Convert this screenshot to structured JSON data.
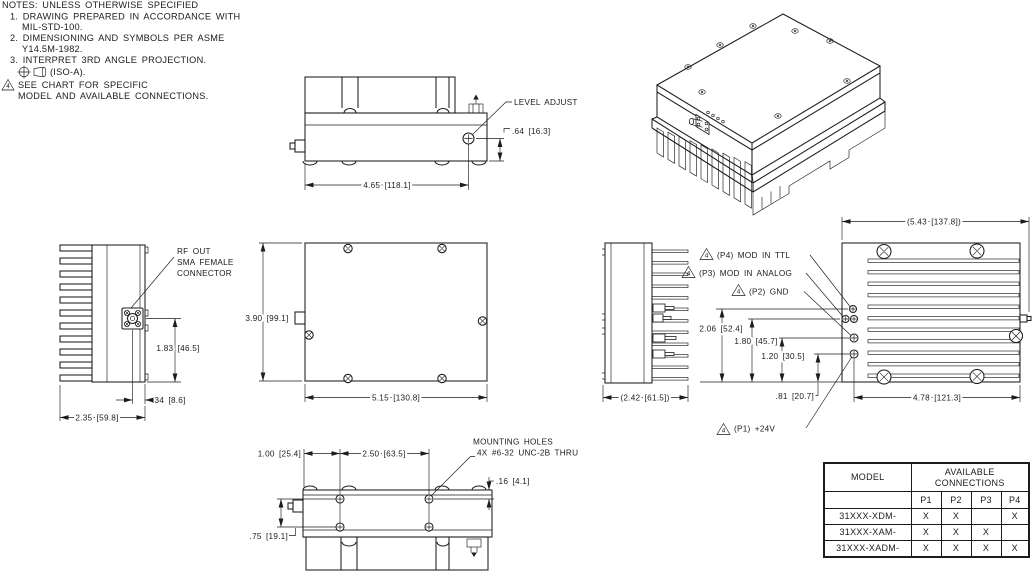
{
  "notes": {
    "header": "NOTES: UNLESS OTHERWISE SPECIFIED",
    "note1_line1": "1. DRAWING PREPARED IN ACCORDANCE WITH",
    "note1_line2": "MIL-STD-100.",
    "note2_line1": "2. DIMENSIONING AND SYMBOLS PER ASME",
    "note2_line2": "Y14.5M-1982.",
    "note3_line1": "3. INTERPRET 3RD ANGLE PROJECTION.",
    "note3_line2": "(ISO-A).",
    "note4_flag": "4",
    "note4_line1": "SEE CHART FOR SPECIFIC",
    "note4_line2": "MODEL AND AVAILABLE CONNECTIONS."
  },
  "front_view": {
    "level_adjust_label": "LEVEL ADJUST",
    "dim_level_adjust_height": ".64 [16.3]",
    "dim_width": "4.65 [118.1]"
  },
  "left_side_view": {
    "rf_out_line1": "RF OUT",
    "rf_out_line2": "SMA FEMALE",
    "rf_out_line3": "CONNECTOR",
    "dim_connector_height": "1.83 [46.5]",
    "dim_connector_offset": ".34 [8.6]",
    "dim_depth": "2.35 [59.8]"
  },
  "top_view": {
    "dim_height": "3.90 [99.1]",
    "dim_width": "5.15 [130.8]"
  },
  "right_side_view": {
    "dim_depth": "(2.42 [61.5])"
  },
  "back_view": {
    "dim_overall_width": "(5.43 [137.8])",
    "dim_mounting_width": "4.78 [121.3]",
    "ports": [
      {
        "flag": "4",
        "label": "(P4) MOD IN TTL",
        "dim": "2.06 [52.4]"
      },
      {
        "flag": "4",
        "label": "(P3) MOD IN ANALOG",
        "dim": "1.80 [45.7]"
      },
      {
        "flag": "4",
        "label": "(P2) GND",
        "dim": "1.20 [30.5]"
      },
      {
        "flag": "4",
        "label": "(P1) +24V",
        "dim": ".81 [20.7]"
      }
    ]
  },
  "mounting_view": {
    "dim_edge_to_hole": "1.00 [25.4]",
    "dim_hole_spacing": "2.50 [63.5]",
    "dim_hole_to_edge": ".16 [4.1]",
    "dim_hole_rows": ".75 [19.1]",
    "holes_label_line1": "MOUNTING HOLES",
    "holes_label_line2": "4X #6-32 UNC-2B THRU"
  },
  "connections_table": {
    "model_header": "MODEL",
    "avail_header_line1": "AVAILABLE",
    "avail_header_line2": "CONNECTIONS",
    "port_headers": [
      "P1",
      "P2",
      "P3",
      "P4"
    ],
    "rows": [
      {
        "model": "31XXX-XDM-",
        "p1": "X",
        "p2": "X",
        "p3": "",
        "p4": "X"
      },
      {
        "model": "31XXX-XAM-",
        "p1": "X",
        "p2": "X",
        "p3": "X",
        "p4": ""
      },
      {
        "model": "31XXX-XADM-",
        "p1": "X",
        "p2": "X",
        "p3": "X",
        "p4": "X"
      }
    ]
  }
}
